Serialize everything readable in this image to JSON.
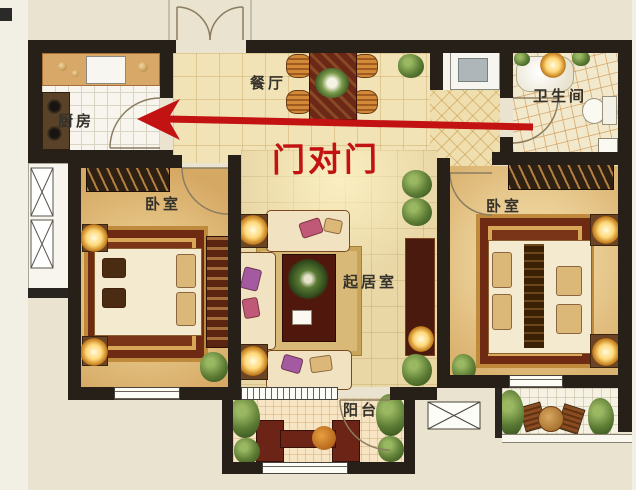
{
  "plan": {
    "type": "apartment-floor-plan",
    "rooms": {
      "dining": {
        "label": "餐厅"
      },
      "kitchen": {
        "label": "厨房"
      },
      "bathroom": {
        "label": "卫生间"
      },
      "bedroom_left": {
        "label": "卧室"
      },
      "bedroom_right": {
        "label": "卧室"
      },
      "living": {
        "label": "起居室"
      },
      "balcony": {
        "label": "阳台"
      }
    }
  },
  "annotation": {
    "arrow_text": "门对门",
    "arrow_color": "#c31212",
    "arrow_direction": "left"
  },
  "palette": {
    "wall": "#262019",
    "paper": "#eae3cf",
    "carpet_red": "#6e2a12",
    "floor_tan": "#d5a863",
    "accent_red": "#c31212"
  }
}
